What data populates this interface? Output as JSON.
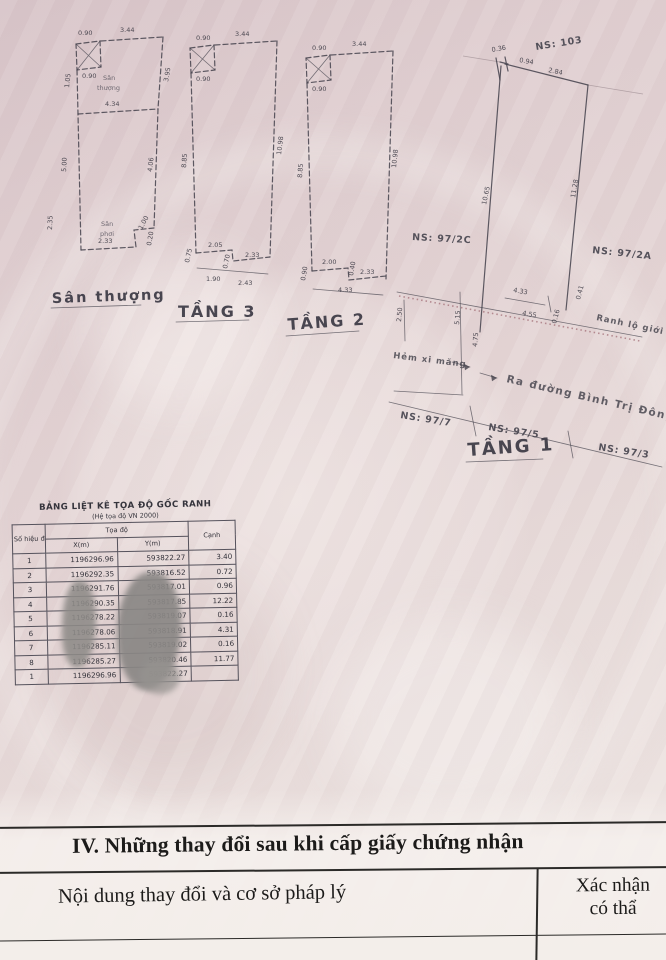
{
  "plans": {
    "santhuong": {
      "label": "Sân thượng",
      "inner_top1": "Sân",
      "inner_top2": "thượng",
      "inner_bot1": "Sân",
      "inner_bot2": "phơi",
      "dims": {
        "top_small": "0.90",
        "top": "3.44",
        "box": "0.90",
        "left_upper": "1.05",
        "left_mid": "5.00",
        "right_upper": "3.95",
        "mid": "4.34",
        "inner_right": "4.06",
        "left_lower": "2.35",
        "bottom": "2.33",
        "notch_w": "1.00",
        "notch_h": "0.20"
      }
    },
    "tang3": {
      "label": "TẦNG 3",
      "dims": {
        "top_small": "0.90",
        "top": "3.44",
        "box": "0.90",
        "left": "8.85",
        "right": "10.98",
        "b1": "2.05",
        "b2": "2.33",
        "b3": "1.90",
        "b4": "2.43",
        "v1": "0.75",
        "v2": "0.70"
      }
    },
    "tang2": {
      "label": "TẦNG 2",
      "dims": {
        "top_small": "0.90",
        "top": "3.44",
        "box": "0.90",
        "left": "8.85",
        "right": "10.98",
        "b1": "2.00",
        "b2": "2.33",
        "b3": "4.33",
        "v1": "0.90",
        "v2": "0.40"
      }
    },
    "tang1": {
      "label": "TẦNG 1",
      "dims": {
        "c1": "0.36",
        "c2": "0.94",
        "top": "2.84",
        "left": "10.65",
        "right": "11.28",
        "d1": "4.33",
        "d2": "4.55",
        "d3": "0.16",
        "d4": "0.41",
        "v1": "2.50",
        "v2": "5.15",
        "v3": "4.75"
      },
      "ann": {
        "ns103": "NS: 103",
        "ns972c": "NS: 97/2C",
        "ns972a": "NS: 97/2A",
        "ns977": "NS: 97/7",
        "ns975": "NS: 97/5",
        "ns973": "NS: 97/3",
        "hem": "Hẻm xi măng",
        "ra_duong": "Ra đường Bình Trị Đông",
        "ranh": "Ranh lộ giới"
      }
    }
  },
  "table": {
    "title": "BẢNG LIỆT KÊ TỌA ĐỘ GỐC RANH",
    "subtitle": "(Hệ tọa độ VN 2000)",
    "headers": {
      "point": "Số hiệu điểm",
      "toado": "Tọa độ",
      "x": "X(m)",
      "y": "Y(m)",
      "canh": "Cạnh"
    },
    "rows": [
      {
        "p": "1",
        "x": "1196296.96",
        "y": "593822.27",
        "c": "3.40"
      },
      {
        "p": "2",
        "x": "1196292.35",
        "y": "593816.52",
        "c": "0.72"
      },
      {
        "p": "3",
        "x": "1196291.76",
        "y": "593817.01",
        "c": "0.96"
      },
      {
        "p": "4",
        "x": "1196290.35",
        "y": "593817.85",
        "c": "12.22"
      },
      {
        "p": "5",
        "x": "1196278.22",
        "y": "593819.07",
        "c": "0.16"
      },
      {
        "p": "6",
        "x": "1196278.06",
        "y": "593818.91",
        "c": "4.31"
      },
      {
        "p": "7",
        "x": "1196285.11",
        "y": "593819.02",
        "c": "0.16"
      },
      {
        "p": "8",
        "x": "1196285.27",
        "y": "593820.46",
        "c": "11.77"
      },
      {
        "p": "1",
        "x": "1196296.96",
        "y": "593822.27",
        "c": ""
      }
    ]
  },
  "section4": {
    "title": "IV. Những thay đổi sau khi cấp giấy chứng nhận",
    "left": "Nội dung thay đổi và cơ sở pháp lý",
    "right1": "Xác nhận",
    "right2": "có thẩ"
  },
  "colors": {
    "paper": "#e3d4d5",
    "paper_light": "#f1eae7",
    "ink": "#3d3b45",
    "doc_ink": "#1c1b1a",
    "redline": "#a06a72",
    "smudge": "#8d8a87"
  }
}
